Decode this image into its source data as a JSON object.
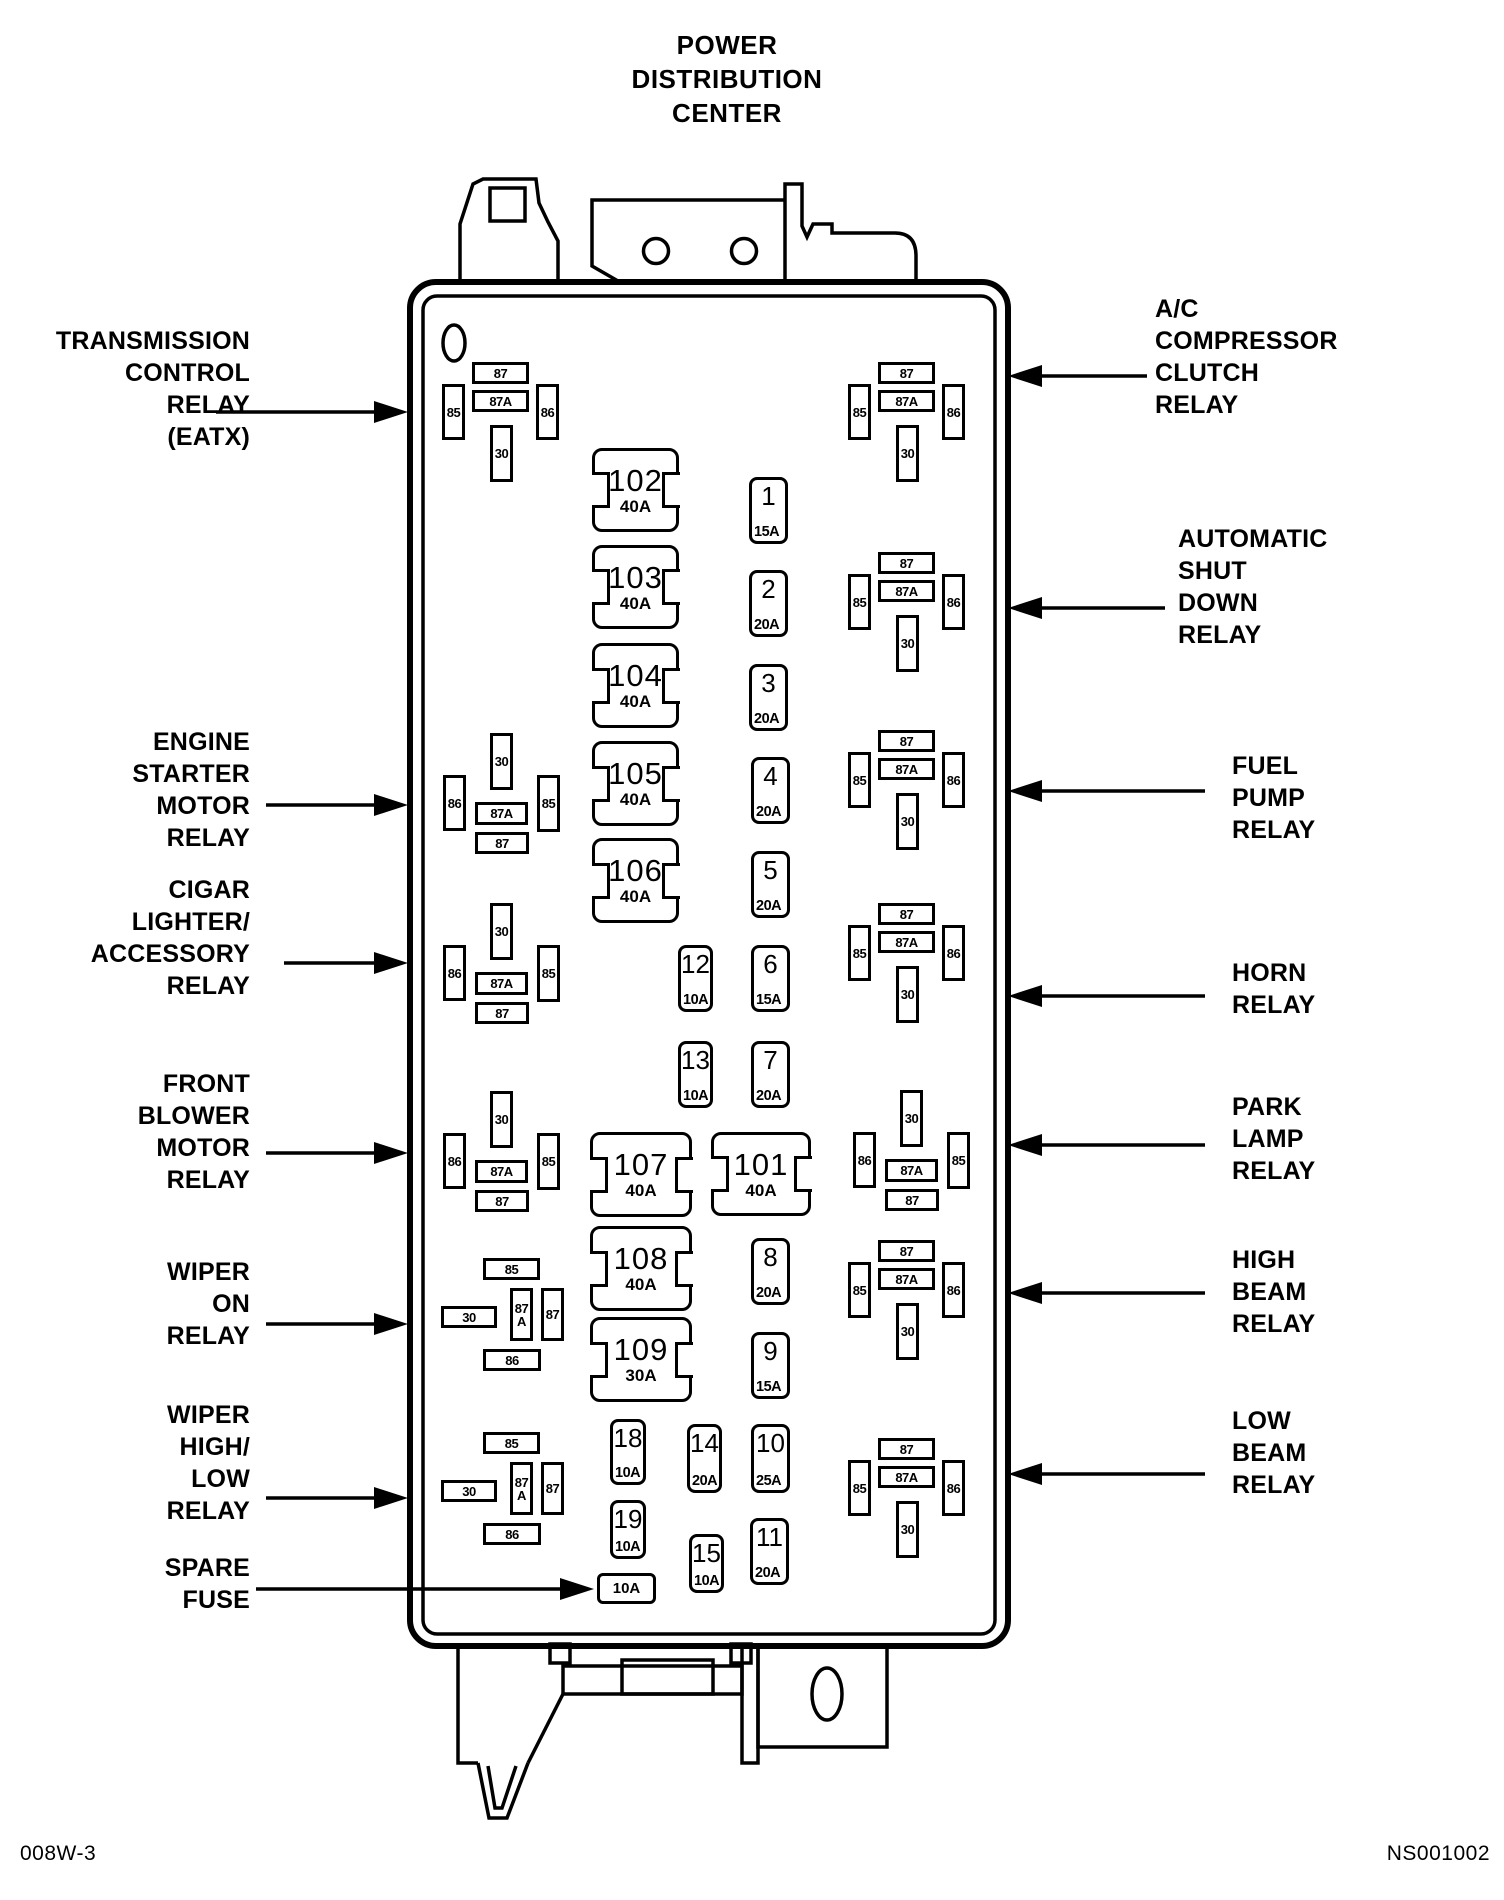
{
  "colors": {
    "line": "#000000",
    "background": "#ffffff"
  },
  "title": {
    "lines": [
      "POWER",
      "DISTRIBUTION",
      "CENTER"
    ]
  },
  "footer": {
    "left": "008W-3",
    "right": "NS001002"
  },
  "left_labels": [
    {
      "id": "transmission-control-relay",
      "lines": [
        "TRANSMISSION",
        "CONTROL",
        "RELAY",
        "(EATX)"
      ]
    },
    {
      "id": "engine-starter-motor-relay",
      "lines": [
        "ENGINE",
        "STARTER",
        "MOTOR",
        "RELAY"
      ]
    },
    {
      "id": "cigar-lighter-accessory-relay",
      "lines": [
        "CIGAR",
        "LIGHTER/",
        "ACCESSORY",
        "RELAY"
      ]
    },
    {
      "id": "front-blower-motor-relay",
      "lines": [
        "FRONT",
        "BLOWER",
        "MOTOR",
        "RELAY"
      ]
    },
    {
      "id": "wiper-on-relay",
      "lines": [
        "WIPER",
        "ON",
        "RELAY"
      ]
    },
    {
      "id": "wiper-high-low-relay",
      "lines": [
        "WIPER",
        "HIGH/",
        "LOW",
        "RELAY"
      ]
    },
    {
      "id": "spare-fuse",
      "lines": [
        "SPARE",
        "FUSE"
      ]
    }
  ],
  "right_labels": [
    {
      "id": "ac-compressor-clutch-relay",
      "lines": [
        "A/C",
        "COMPRESSOR",
        "CLUTCH",
        "RELAY"
      ]
    },
    {
      "id": "automatic-shut-down-relay",
      "lines": [
        "AUTOMATIC",
        "SHUT",
        "DOWN",
        "RELAY"
      ]
    },
    {
      "id": "fuel-pump-relay",
      "lines": [
        "FUEL",
        "PUMP",
        "RELAY"
      ]
    },
    {
      "id": "horn-relay",
      "lines": [
        "HORN",
        "RELAY"
      ]
    },
    {
      "id": "park-lamp-relay",
      "lines": [
        "PARK",
        "LAMP",
        "RELAY"
      ]
    },
    {
      "id": "high-beam-relay",
      "lines": [
        "HIGH",
        "BEAM",
        "RELAY"
      ]
    },
    {
      "id": "low-beam-relay",
      "lines": [
        "LOW",
        "BEAM",
        "RELAY"
      ]
    }
  ],
  "large_fuses": [
    {
      "number": "102",
      "amp": "40A"
    },
    {
      "number": "103",
      "amp": "40A"
    },
    {
      "number": "104",
      "amp": "40A"
    },
    {
      "number": "105",
      "amp": "40A"
    },
    {
      "number": "106",
      "amp": "40A"
    },
    {
      "number": "107",
      "amp": "40A"
    },
    {
      "number": "101",
      "amp": "40A"
    },
    {
      "number": "108",
      "amp": "40A"
    },
    {
      "number": "109",
      "amp": "30A"
    }
  ],
  "small_fuses": [
    {
      "number": "1",
      "amp": "15A"
    },
    {
      "number": "2",
      "amp": "20A"
    },
    {
      "number": "3",
      "amp": "20A"
    },
    {
      "number": "4",
      "amp": "20A"
    },
    {
      "number": "5",
      "amp": "20A"
    },
    {
      "number": "6",
      "amp": "15A"
    },
    {
      "number": "7",
      "amp": "20A"
    },
    {
      "number": "8",
      "amp": "20A"
    },
    {
      "number": "9",
      "amp": "15A"
    },
    {
      "number": "10",
      "amp": "25A"
    },
    {
      "number": "11",
      "amp": "20A"
    },
    {
      "number": "12",
      "amp": "10A"
    },
    {
      "number": "13",
      "amp": "10A"
    },
    {
      "number": "14",
      "amp": "20A"
    },
    {
      "number": "15",
      "amp": "10A"
    },
    {
      "number": "18",
      "amp": "10A"
    },
    {
      "number": "19",
      "amp": "10A"
    }
  ],
  "spare_fuse": {
    "amp": "10A"
  },
  "relays": [
    {
      "name": "transmission-control-relay-socket",
      "pins": {
        "top": "87",
        "middle": "87A",
        "left": "85",
        "right": "86",
        "bottom": "30"
      }
    },
    {
      "name": "engine-starter-motor-relay-socket",
      "pins": {
        "top": "30",
        "left": "86",
        "middle": "87A",
        "right": "85",
        "bottom": "87"
      }
    },
    {
      "name": "cigar-lighter-accessory-relay-socket",
      "pins": {
        "top": "30",
        "left": "86",
        "middle": "87A",
        "right": "85",
        "bottom": "87"
      }
    },
    {
      "name": "front-blower-motor-relay-socket",
      "pins": {
        "top": "30",
        "left": "86",
        "middle": "87A",
        "right": "85",
        "bottom": "87"
      }
    },
    {
      "name": "wiper-on-relay-socket",
      "pins": {
        "top": "85",
        "left": "30",
        "middle": "87A",
        "right": "87",
        "bottom": "86"
      }
    },
    {
      "name": "wiper-high-low-relay-socket",
      "pins": {
        "top": "85",
        "left": "30",
        "middle": "87A",
        "right": "87",
        "bottom": "86"
      }
    },
    {
      "name": "ac-compressor-clutch-relay-socket",
      "pins": {
        "top": "87",
        "middle": "87A",
        "left": "85",
        "right": "86",
        "bottom": "30"
      }
    },
    {
      "name": "automatic-shut-down-relay-socket",
      "pins": {
        "top": "87",
        "middle": "87A",
        "left": "85",
        "right": "86",
        "bottom": "30"
      }
    },
    {
      "name": "fuel-pump-relay-socket",
      "pins": {
        "top": "87",
        "middle": "87A",
        "left": "85",
        "right": "86",
        "bottom": "30"
      }
    },
    {
      "name": "horn-relay-socket",
      "pins": {
        "top": "87",
        "middle": "87A",
        "left": "85",
        "right": "86",
        "bottom": "30"
      }
    },
    {
      "name": "park-lamp-relay-socket",
      "pins": {
        "top": "30",
        "left": "86",
        "middle": "87A",
        "right": "85",
        "bottom": "87"
      }
    },
    {
      "name": "high-beam-relay-socket",
      "pins": {
        "top": "87",
        "middle": "87A",
        "left": "85",
        "right": "86",
        "bottom": "30"
      }
    },
    {
      "name": "low-beam-relay-socket",
      "pins": {
        "top": "87",
        "middle": "87A",
        "left": "85",
        "right": "86",
        "bottom": "30"
      }
    }
  ]
}
